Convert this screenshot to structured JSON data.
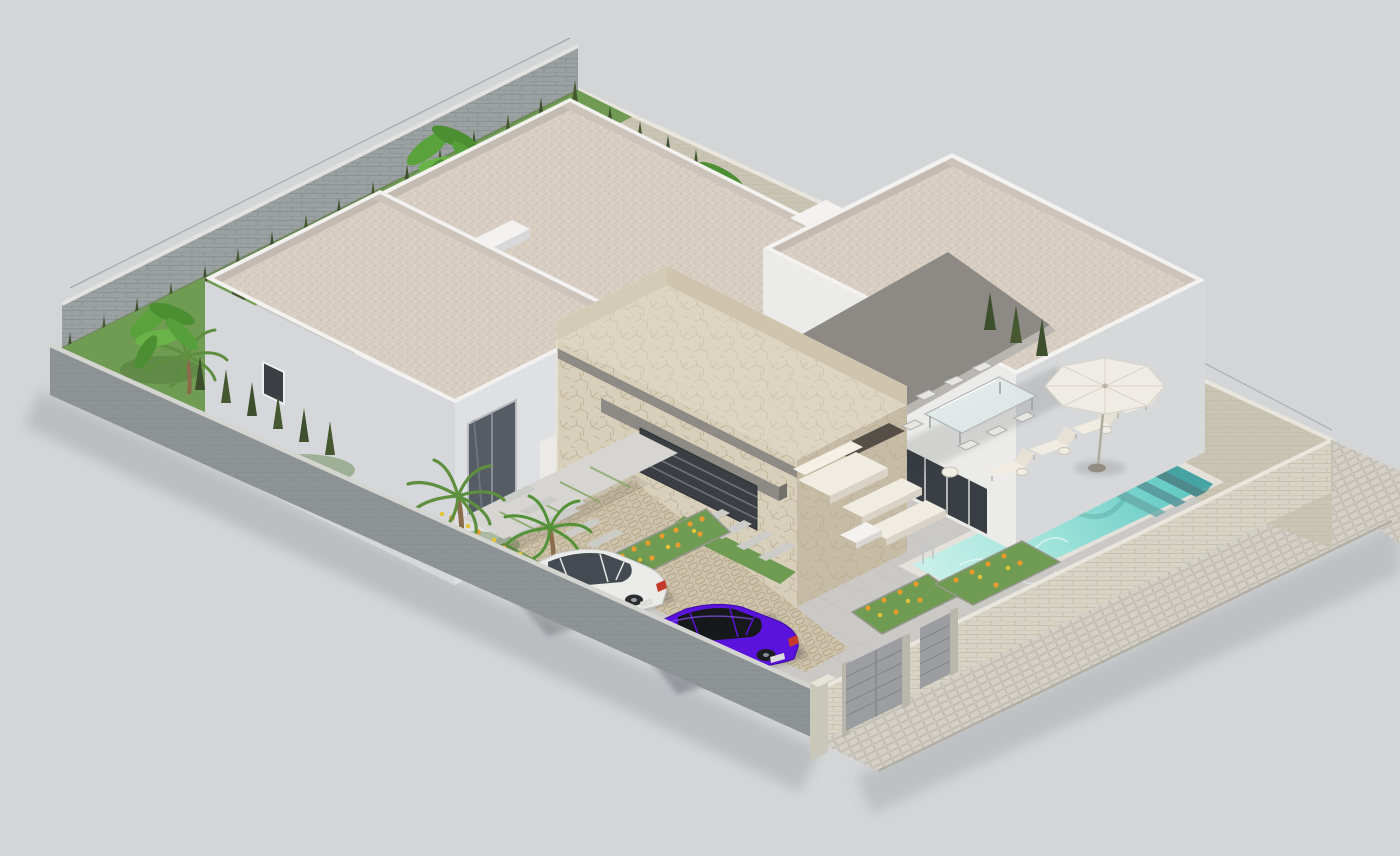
{
  "canvas": {
    "width": 1400,
    "height": 856
  },
  "colors": {
    "bg": "#d4d5d6",
    "paving": "#cac9c5",
    "sidewalk": "#d3d0c8",
    "wall_gray": "#9ba1a2",
    "wall_gray_dark": "#8e9496",
    "wall_beige": "#d8d3c4",
    "wall_beige_shade": "#c9c4b4",
    "wall_cap": "#e9e7e2",
    "white_lit": "#ebebe9",
    "white_mid": "#d6d7da",
    "white_shade": "#dddee0",
    "parapet": "#f3f2f0",
    "gravel": "#d8cfc2",
    "gravel_band": "#c3bbb1",
    "stone_lit": "#d8cfba",
    "stone_shade": "#c6bba4",
    "stone_cap": "#ddd5c2",
    "awning": "#8d8a86",
    "awning_edge": "#b9b6b1",
    "glass": "#3b3f43",
    "wood": "#6b5340",
    "grass": "#6f9b53",
    "grass_dark": "#587e41",
    "cypress": "#3d4f2d",
    "banana": "#5aa23c",
    "palm": "#5d8f3f",
    "flower_orange": "#e89b2e",
    "flower_yellow": "#e4c43a",
    "pool_deep": "#5cc6c1",
    "pool_mid": "#93dfd8",
    "pool_shallow": "#c7f0e9",
    "pool_step": "#4e8a8c",
    "pool_coping": "#e3e1da",
    "drive_cobble": "#cdc2aa",
    "gate": "#9b9da0",
    "umbrella": "#efece6",
    "cushion": "#f0ece1",
    "car_white": "#ebebe9",
    "car_purple": "#5a13dc",
    "tire": "#2b2e31",
    "taillight": "#c63a2c",
    "shadow": "#9aa0a6"
  },
  "scene": {
    "type": "3d-architectural-render",
    "view": "isometric aerial",
    "objects": [
      "perimeter-walls",
      "back-house",
      "left-house",
      "right-house",
      "stone-feature-wall",
      "gray-awning",
      "swimming-pool",
      "pool-ladder",
      "sun-loungers",
      "parasol",
      "outdoor-dining-set",
      "lounge-sofa-set",
      "white-hatchback-car",
      "purple-sedan-car",
      "cobbled-driveway",
      "entrance-gates",
      "public-sidewalk",
      "cypress-hedge",
      "banana-plants",
      "palm-trees",
      "flower-beds",
      "lawn-patches",
      "stepping-stone-paths"
    ]
  }
}
